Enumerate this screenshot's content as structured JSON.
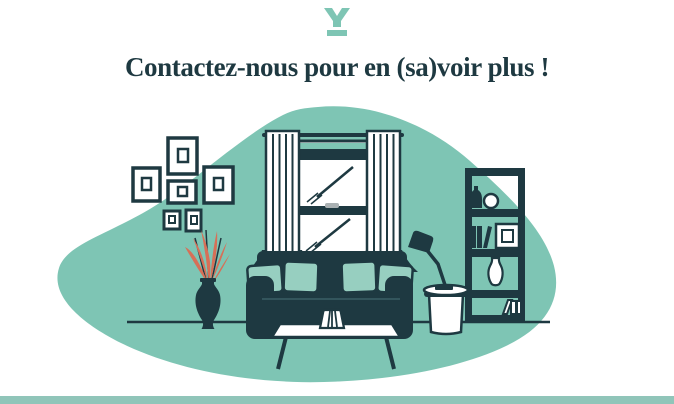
{
  "header": {
    "logo_icon": "brand-y-logo-icon",
    "title": "Contactez-nous pour en (sa)voir plus !"
  },
  "colors": {
    "teal": "#7ec5b4",
    "teal_muted": "#90c5b9",
    "dark": "#1e3941",
    "coral": "#d76f57",
    "pillow": "#97cfc0",
    "handle_gray": "#aab1b3"
  },
  "illustration": {
    "name": "living-room-illustration",
    "items": [
      "background-blob",
      "floor-line",
      "wall-picture-frames",
      "curtained-window",
      "plant-in-vase",
      "bookshelf",
      "side-table",
      "desk-lamp",
      "sofa-with-cushions",
      "coffee-table",
      "table-vase"
    ]
  },
  "footer": {
    "divider": "teal-bar"
  }
}
